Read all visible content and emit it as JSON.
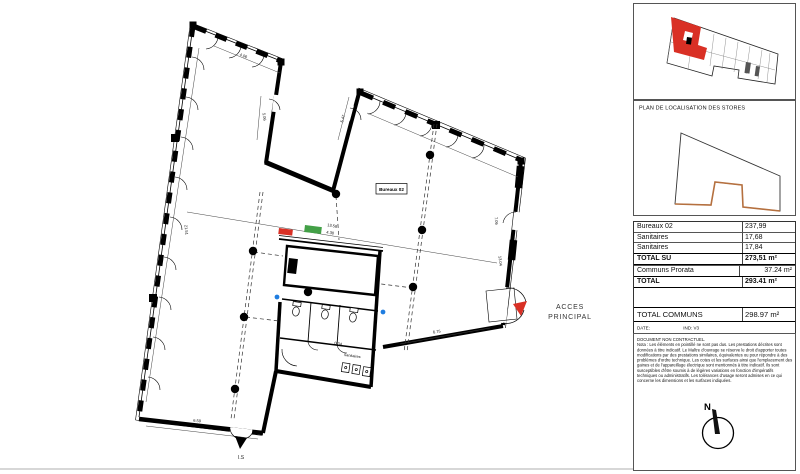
{
  "plan": {
    "unit_label": "Bureaux 02",
    "access": {
      "line1": "ACCES",
      "line2": "PRINCIPAL"
    },
    "exit_label": "I.S",
    "sanitaires_label": "Sanitaires",
    "dimensions": {
      "top_edge": "4.06",
      "left_inner": "5.06",
      "left_wall": "21.51",
      "right_wing_inner": "5.47",
      "mid_main": "13.58",
      "mid_sub": "4.30",
      "bottom_right": "6.75",
      "right_wall_upper": "7.06",
      "right_wall_lower": "13.04",
      "bottom_left": "6.59",
      "sanitary": "0.34"
    }
  },
  "sidebar": {
    "stores_title": "PLAN DE LOCALISATION DES STORES",
    "surface_table": {
      "rows": [
        {
          "label": "Bureaux 02",
          "value": "237,99"
        },
        {
          "label": "Sanitaires",
          "value": "17,68"
        },
        {
          "label": "Sanitaires",
          "value": "17,84"
        },
        {
          "label": "TOTAL SU",
          "value": "273,51 m²"
        },
        {
          "label": "Communs Prorata",
          "value": "37.24 m²"
        },
        {
          "label": "TOTAL",
          "value": "293.41 m²"
        }
      ]
    },
    "total_communs": {
      "label": "TOTAL COMMUNS",
      "value": "298.97 m²"
    },
    "date_row": {
      "date": "DATE:   01/07/2025",
      "ind": "IND: V3 NOTAIRE"
    },
    "disclaimer": {
      "title": "DOCUMENT NON CONTRACTUEL.",
      "body": "Nota : Les éléments en pointillé ne sont pas dus. Les prestations décrites sont données à titre indicatif. Le Maître d'ouvrage se réserve le droit d'apporter toutes modifications par des prestations similaires, équivalentes ou pour répondre à des problèmes d'ordre technique. Les cotes et les surfaces ainsi que l'emplacement des gaines et de l'appareillage électrique sont mentionnés à titre indicatif. Ils sont susceptibles d'être soumis à de légères variations en fonction d'impératifs techniques ou administratifs. Les tolérances d'usage seront admises en ce qui concerne les dimensions et les surfaces indiquées."
    },
    "compass_label": "N"
  },
  "colors": {
    "accent_red": "#d93025",
    "marker_green": "#43a047",
    "marker_blue": "#1f7de0",
    "stores_orange": "#b5703f",
    "wall_black": "#000000"
  }
}
